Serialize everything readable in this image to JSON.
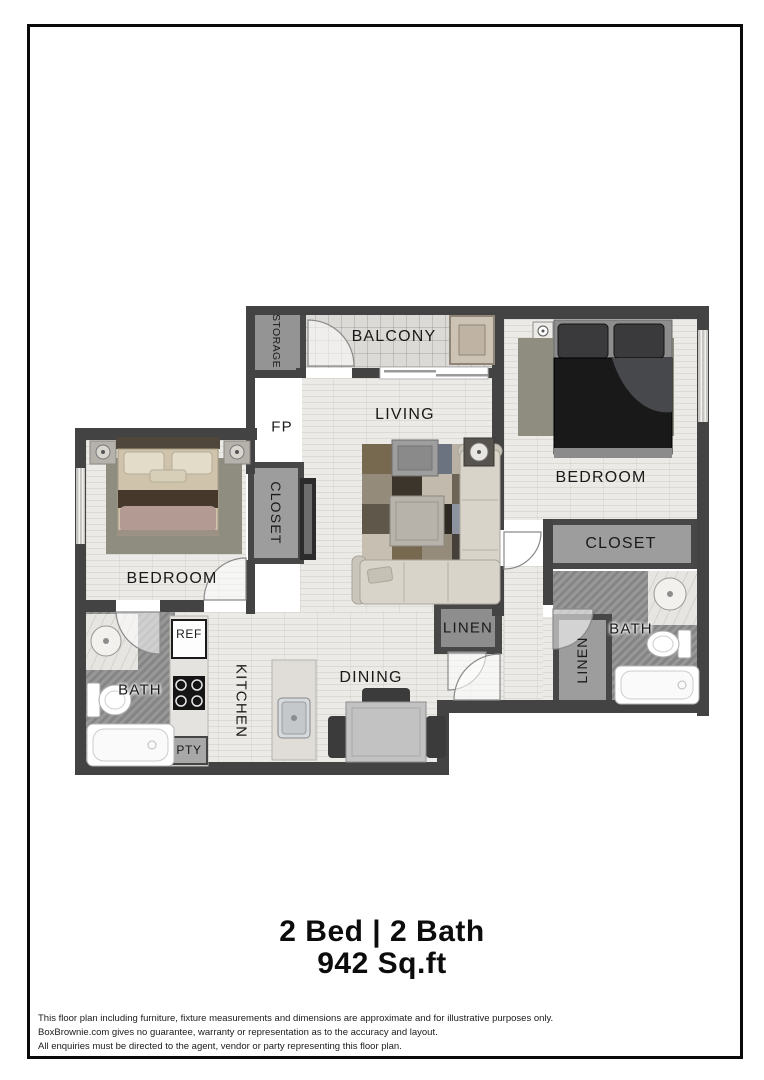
{
  "plan": {
    "rooms": {
      "balcony": "BALCONY",
      "storage": "STORAGE",
      "living": "LIVING",
      "fireplace": "FP",
      "bedroom_left": "BEDROOM",
      "bedroom_right": "BEDROOM",
      "closet_left": "CLOSET",
      "closet_right": "CLOSET",
      "linen_hall": "LINEN",
      "linen_closet": "LINEN",
      "bath_left": "BATH",
      "bath_right": "BATH",
      "kitchen": "KITCHEN",
      "dining": "DINING",
      "refrigerator": "REF",
      "pantry": "PTY"
    }
  },
  "title": {
    "line1": "2 Bed | 2 Bath",
    "line2": "942 Sq.ft"
  },
  "disclaimer": {
    "line1": "This floor plan including furniture, fixture measurements and dimensions are approximate and for illustrative purposes only.",
    "line2": "BoxBrownie.com gives no guarantee, warranty or representation as to the accuracy and layout.",
    "line3": "All enquiries must be directed to the agent, vendor or party representing this floor plan."
  },
  "colors": {
    "wall": "#434343",
    "floor_light": "#ebeae6",
    "floor_bath": "#8f8f8f",
    "closet_fill": "#9d9d9d",
    "frame": "#0a0a0a"
  }
}
